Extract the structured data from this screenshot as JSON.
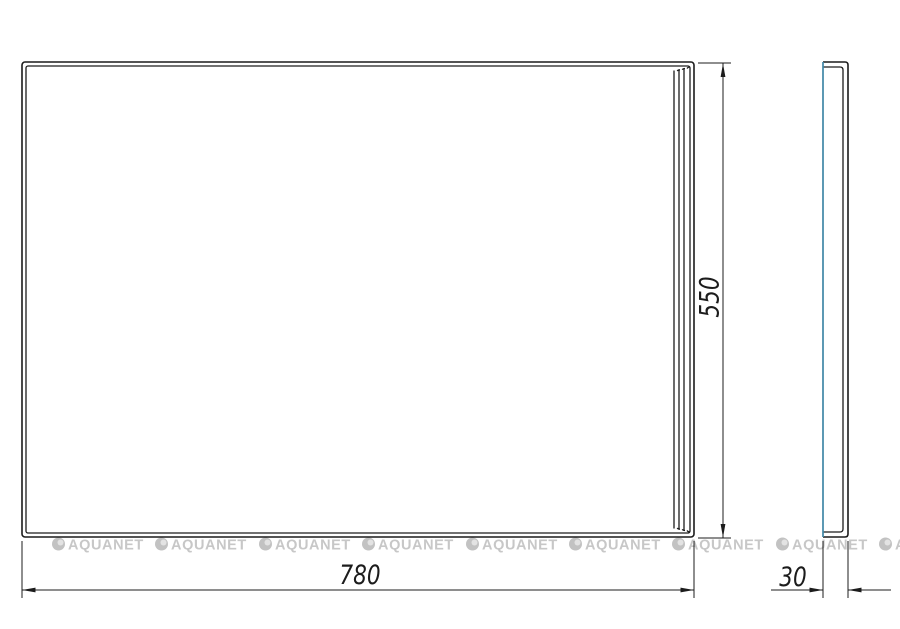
{
  "drawing": {
    "type": "technical-drawing",
    "subject": "mirror panel front and side views",
    "dimensions": {
      "width": {
        "value": "780"
      },
      "height": {
        "value": "550"
      },
      "depth": {
        "value": "30"
      }
    }
  },
  "watermark": {
    "text": "AQUANET",
    "repeat_count": 9,
    "logo_icon": "aquanet-circle-logo"
  },
  "colors": {
    "line": "#1c1c1c",
    "mirror_edge_blue": "#3f87a6",
    "watermark_gray": "#c7c7c7",
    "background": "#ffffff"
  }
}
